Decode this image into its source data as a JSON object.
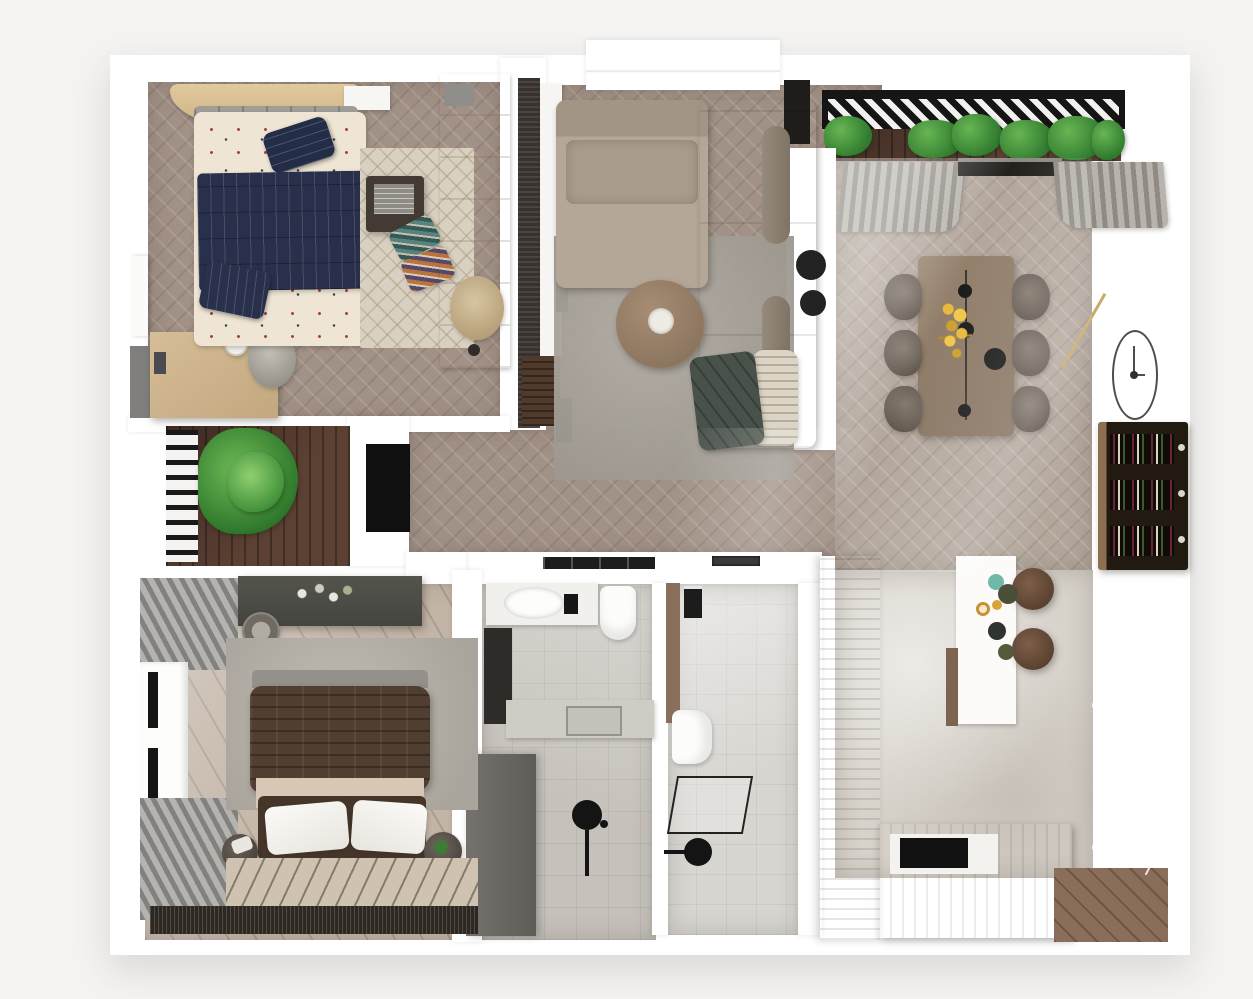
{
  "scene": {
    "type": "3d-floor-plan-render",
    "view": "top-down",
    "description": "Photorealistic top-down 3D render of an apartment floor plan with two bedrooms, living room, dining area, kitchen, two bathrooms, hallway, balcony and terrace",
    "visible_text": "none"
  },
  "palette": {
    "page_background": "#f4f3f1",
    "walls": "#ffffff",
    "herringbone_floor": "#a29186",
    "dining_floor": "#b3a79c",
    "bedroom2_floor": "#c2b4a6",
    "kitchen_marble": "#d7d2ca",
    "bath_tiles": "#c6c2bb",
    "sofa_taupe": "#b5a797",
    "light_wood": "#d9c295",
    "dining_table_wood": "#8d7a69",
    "kitchen_wood": "#927763",
    "terrace_deck": "#5c4033",
    "navy_textile": "#28304b",
    "brown_duvet": "#503f31",
    "plant_green": "#3c8c35",
    "accent_black": "#141414"
  },
  "rooms": [
    {
      "name": "bedroom-1",
      "furniture": [
        "curved-wood-headboard",
        "double-bed-navy-blanket",
        "navy-pillow",
        "patterned-rug",
        "side-box-table",
        "accent-pillows",
        "desk-with-lamp",
        "desk-chair",
        "wardrobe",
        "lounge-chair",
        "floor-lamp",
        "grey-accent-wall",
        "door"
      ]
    },
    {
      "name": "living-room",
      "furniture": [
        "slatted-media-wall",
        "tv",
        "white-console",
        "l-shaped-sofa",
        "bolster-cushions",
        "fringed-pillow",
        "green-throw",
        "area-rug",
        "round-coffee-table",
        "pendant-lamps"
      ]
    },
    {
      "name": "balcony",
      "furniture": [
        "pergola-louvers",
        "planter-greenery",
        "wood-decking"
      ]
    },
    {
      "name": "dining-area",
      "furniture": [
        "curtains",
        "window",
        "dining-table",
        "six-chairs",
        "yellow-flowers",
        "black-pendants",
        "wall-clock",
        "gold-trim",
        "wine-rack"
      ]
    },
    {
      "name": "hallway",
      "furniture": [
        "tv-niche",
        "herringbone-runner"
      ]
    },
    {
      "name": "terrace",
      "furniture": [
        "black-railing",
        "palm-plant",
        "wood-decking"
      ]
    },
    {
      "name": "kitchen",
      "furniture": [
        "counter-with-cooktop",
        "counter-sink",
        "wood-peninsula",
        "white-island",
        "bar-stools",
        "tableware",
        "bottom-counter-cooktop",
        "panel-wall",
        "wood-floor-patch"
      ]
    },
    {
      "name": "bathroom-1",
      "furniture": [
        "vanity-sink",
        "black-faucet",
        "toilet",
        "dark-mirror-cabinet",
        "stone-counter-sink",
        "shower-fixture",
        "tall-grey-wardrobe"
      ]
    },
    {
      "name": "bathroom-2",
      "furniture": [
        "flush-plate",
        "toilet",
        "glass-shower-tray",
        "black-shower-head",
        "wood-door"
      ]
    },
    {
      "name": "bedroom-2",
      "furniture": [
        "striped-curtains",
        "window-black-frames",
        "vanity-dresser",
        "stool",
        "area-rug",
        "bed-brown-duvet",
        "white-pillows",
        "side-baskets",
        "striped-mat",
        "fringe-rug"
      ]
    }
  ]
}
